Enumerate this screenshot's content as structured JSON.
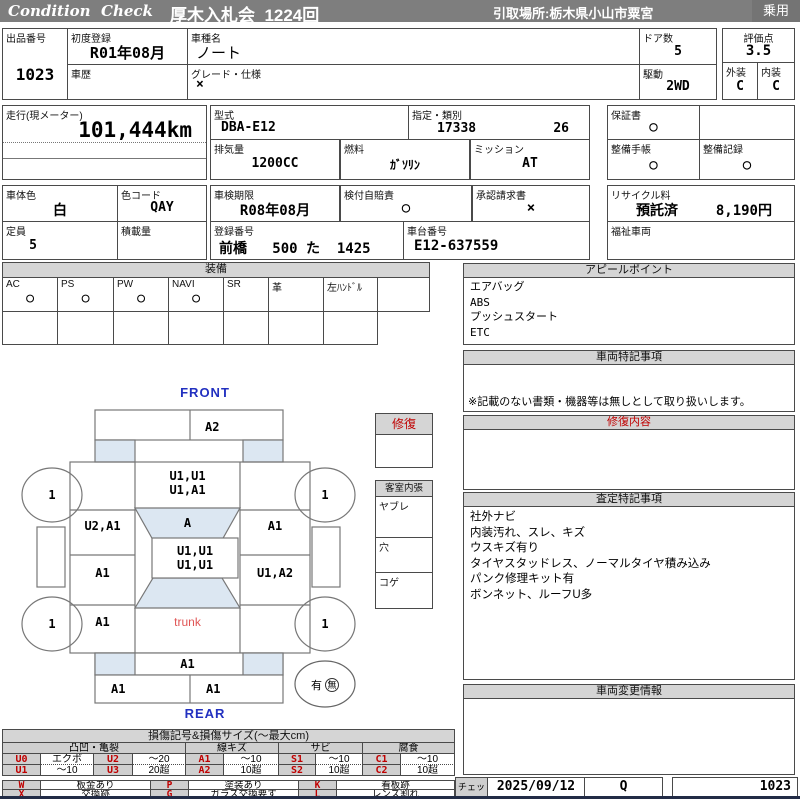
{
  "header": {
    "brand": "Condition  Check",
    "auction": "厚木入札会  1224回",
    "pickup": "引取場所:栃木県小山市粟宮",
    "category": "乗用"
  },
  "info": {
    "auction_no": {
      "label": "出品番号",
      "value": "1023"
    },
    "first_reg": {
      "label": "初度登録",
      "value": "R01年08月"
    },
    "history": {
      "label": "車歴",
      "value": ""
    },
    "model_name": {
      "label": "車種名",
      "value": "ノート"
    },
    "grade": {
      "label": "グレード・仕様",
      "value": "×"
    },
    "doors": {
      "label": "ドア数",
      "value": "5"
    },
    "drive": {
      "label": "駆動",
      "value": "2WD"
    },
    "score": {
      "label": "評価点",
      "value": "3.5"
    },
    "exterior_grade": {
      "label": "外装",
      "value": "C"
    },
    "interior_grade": {
      "label": "内装",
      "value": "C"
    },
    "mileage": {
      "label": "走行(現メーター)",
      "value": "101,444km"
    },
    "model_code": {
      "label": "型式",
      "value": "DBA-E12"
    },
    "class_no": {
      "label": "指定・類別",
      "value1": "17338",
      "value2": "26"
    },
    "displacement": {
      "label": "排気量",
      "value": "1200CC"
    },
    "fuel": {
      "label": "燃料",
      "value": "ｶﾞｿﾘﾝ"
    },
    "transmission": {
      "label": "ミッション",
      "value": "AT"
    },
    "warranty": {
      "label": "保証書",
      "value": "○"
    },
    "maintenance_book": {
      "label": "整備手帳",
      "value": "○"
    },
    "maintenance_record": {
      "label": "整備記録",
      "value": "○"
    },
    "body_color": {
      "label": "車体色",
      "value": "白"
    },
    "color_code": {
      "label": "色コード",
      "value": "QAY"
    },
    "capacity": {
      "label": "定員",
      "value": "5"
    },
    "load": {
      "label": "積載量",
      "value": ""
    },
    "inspection": {
      "label": "車検期限",
      "value": "R08年08月"
    },
    "insurance": {
      "label": "検付自賠責",
      "value": "○"
    },
    "approval": {
      "label": "承認請求書",
      "value": "×"
    },
    "reg_no": {
      "label": "登録番号",
      "value": "前橋   500 た  1425"
    },
    "chassis_no": {
      "label": "車台番号",
      "value": "E12-637559"
    },
    "recycle": {
      "label": "リサイクル料",
      "value1": "預託済",
      "value2": "8,190円"
    },
    "welfare": {
      "label": "福祉車両",
      "value": ""
    }
  },
  "equipment": {
    "title": "装備",
    "items": [
      {
        "label": "AC",
        "mark": "○"
      },
      {
        "label": "PS",
        "mark": "○"
      },
      {
        "label": "PW",
        "mark": "○"
      },
      {
        "label": "NAVI",
        "mark": "○"
      },
      {
        "label": "SR",
        "mark": ""
      },
      {
        "label": "革",
        "mark": ""
      },
      {
        "label": "左ﾊﾝﾄﾞﾙ",
        "mark": ""
      },
      {
        "label": "",
        "mark": ""
      }
    ]
  },
  "appeal": {
    "title": "アピールポイント",
    "lines": [
      "エアバッグ",
      "ABS",
      "プッシュスタート",
      "ETC"
    ]
  },
  "special_notes": {
    "title": "車両特記事項",
    "footnote": "※記載のない書類・機器等は無しとして取り扱いします。"
  },
  "repair_detail": {
    "title": "修復内容"
  },
  "assessment": {
    "title": "査定特記事項",
    "lines": [
      "社外ナビ",
      "内装汚れ、スレ、キズ",
      "ウスキズ有り",
      "タイヤスタッドレス、ノーマルタイヤ積み込み",
      "パンク修理キット有",
      "ボンネット、ルーフU多"
    ]
  },
  "change_info": {
    "title": "車両変更情報"
  },
  "repair_flag": {
    "title": "修復"
  },
  "cabin": {
    "title": "客室内張",
    "items": [
      "ヤブレ",
      "穴",
      "コゲ"
    ]
  },
  "diagram": {
    "front_label": "FRONT",
    "rear_label": "REAR",
    "front_bumper_right": "A2",
    "hood_line1": "U1,U1",
    "hood_line2": "U1,A1",
    "windshield": "A",
    "left_front_fender": "U2,A1",
    "right_front_fender": "A1",
    "left_door": "A1",
    "roof_line1": "U1,U1",
    "roof_line2": "U1,U1",
    "right_door": "U1,A2",
    "left_quarter": "A1",
    "trunk": "trunk",
    "rear_panel": "A1",
    "rear_bumper_left": "A1",
    "rear_bumper_right": "A1",
    "wheel_mark": "1",
    "spare_yes": "有",
    "spare_no": "無"
  },
  "legend": {
    "title": "損傷記号&損傷サイズ(〜最大cm)",
    "groups": [
      "凸凹・亀裂",
      "線キズ",
      "サビ",
      "腐食"
    ],
    "rows": [
      [
        "U0",
        "エクボ",
        "U2",
        "〜20",
        "A1",
        "〜10",
        "S1",
        "〜10",
        "C1",
        "〜10"
      ],
      [
        "U1",
        "〜10",
        "U3",
        "20超",
        "A2",
        "10超",
        "S2",
        "10超",
        "C2",
        "10超"
      ]
    ],
    "extra": [
      [
        "W",
        "板金あり",
        "P",
        "塗装あり",
        "K",
        "看板跡"
      ],
      [
        "X",
        "交換跡",
        "G",
        "ガラス交換要す",
        "L",
        "レンズ割れ"
      ]
    ]
  },
  "check": {
    "label": "チェック",
    "date": "2025/09/12",
    "inspector": "Q",
    "number": "1023"
  },
  "colors": {
    "accent_blue": "#2230c0",
    "alert_red": "#c00000",
    "panel_blue": "#dce7f2"
  }
}
